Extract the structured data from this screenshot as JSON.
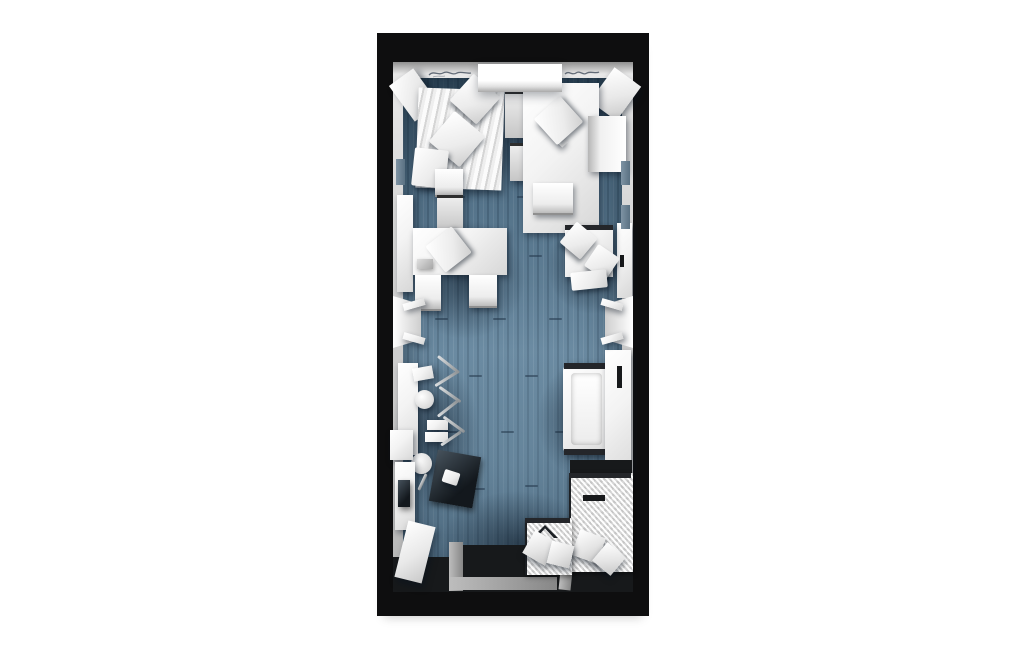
{
  "scene": {
    "description": "3D top-down render of a narrow studio room floor plan on a white background",
    "background": "#ffffff",
    "colors": {
      "outer_wall": "#0e0e0f",
      "wall_lining": "#cfcfcf",
      "floor": "#5f8098",
      "floor_shadow": "#31465a",
      "furniture": "#f3f3f3",
      "entry_floor": "#17191b",
      "ramp": "#9a9a9a",
      "bath_mat": "#ededed"
    },
    "wall_inscriptions": {
      "left": "illegible cursive inscription on top wall (left of beam)",
      "right": "illegible cursive inscription on top wall (right of beam)"
    }
  },
  "plan": {
    "items": [
      {
        "n": "floor-seam",
        "k": "seam",
        "x": 75,
        "y": 163,
        "w": 13,
        "h": 2
      },
      {
        "n": "floor-seam",
        "k": "seam",
        "x": 140,
        "y": 163,
        "w": 13,
        "h": 2
      },
      {
        "n": "floor-seam",
        "k": "seam",
        "x": 196,
        "y": 160,
        "w": 13,
        "h": 2
      },
      {
        "n": "floor-seam",
        "k": "seam",
        "x": 97,
        "y": 222,
        "w": 13,
        "h": 2
      },
      {
        "n": "floor-seam",
        "k": "seam",
        "x": 152,
        "y": 222,
        "w": 13,
        "h": 2
      },
      {
        "n": "floor-seam",
        "k": "seam",
        "x": 58,
        "y": 285,
        "w": 13,
        "h": 2
      },
      {
        "n": "floor-seam",
        "k": "seam",
        "x": 116,
        "y": 285,
        "w": 13,
        "h": 2
      },
      {
        "n": "floor-seam",
        "k": "seam",
        "x": 172,
        "y": 285,
        "w": 13,
        "h": 2
      },
      {
        "n": "floor-seam",
        "k": "seam",
        "x": 92,
        "y": 342,
        "w": 13,
        "h": 2
      },
      {
        "n": "floor-seam",
        "k": "seam",
        "x": 148,
        "y": 342,
        "w": 13,
        "h": 2
      },
      {
        "n": "floor-seam",
        "k": "seam",
        "x": 203,
        "y": 342,
        "w": 13,
        "h": 2
      },
      {
        "n": "floor-seam",
        "k": "seam",
        "x": 68,
        "y": 398,
        "w": 13,
        "h": 2
      },
      {
        "n": "floor-seam",
        "k": "seam",
        "x": 124,
        "y": 398,
        "w": 13,
        "h": 2
      },
      {
        "n": "floor-seam",
        "k": "seam",
        "x": 178,
        "y": 398,
        "w": 13,
        "h": 2
      },
      {
        "n": "floor-seam",
        "k": "seam",
        "x": 95,
        "y": 455,
        "w": 13,
        "h": 2
      },
      {
        "n": "floor-seam",
        "k": "seam",
        "x": 148,
        "y": 452,
        "w": 13,
        "h": 2
      },
      {
        "n": "floor-shadow-top-right",
        "k": "shadow",
        "x": 110,
        "y": 46,
        "w": 118,
        "h": 125
      },
      {
        "n": "floor-shadow-bed-top-left",
        "k": "shadow",
        "x": 32,
        "y": 56,
        "w": 106,
        "h": 115
      },
      {
        "n": "floor-shadow-desk-left",
        "k": "shadow",
        "x": 28,
        "y": 186,
        "w": 120,
        "h": 120
      },
      {
        "n": "floor-shadow-armchair",
        "k": "shadow",
        "x": 170,
        "y": 186,
        "w": 88,
        "h": 95
      },
      {
        "n": "floor-shadow-bed-right",
        "k": "shadow",
        "x": 160,
        "y": 328,
        "w": 98,
        "h": 118
      },
      {
        "n": "floor-shadow-counter",
        "k": "shadow",
        "x": 14,
        "y": 326,
        "w": 88,
        "h": 152
      },
      {
        "n": "floor-shadow-bottom",
        "k": "shadow",
        "x": 64,
        "y": 458,
        "w": 152,
        "h": 104
      },
      {
        "n": "beam-light-glow",
        "k": "glow",
        "x": 94,
        "y": 50,
        "w": 100,
        "h": 60
      },
      {
        "n": "entry-floor",
        "k": "dark",
        "x": 78,
        "y": 512,
        "w": 178,
        "h": 47
      },
      {
        "n": "entry-floor-left",
        "k": "dark",
        "x": 16,
        "y": 524,
        "w": 66,
        "h": 35
      },
      {
        "n": "entry-ramp-side",
        "k": "grayramp",
        "x": 72,
        "y": 509,
        "w": 14,
        "h": 49
      },
      {
        "n": "entry-ramp-bottom",
        "k": "grayramp",
        "x": 72,
        "y": 544,
        "w": 108,
        "h": 13
      },
      {
        "n": "entry-ramp-divider",
        "k": "grayramp",
        "x": 184,
        "y": 509,
        "w": 12,
        "h": 48,
        "r": 6
      },
      {
        "n": "corner-panel-top-left",
        "k": "panel",
        "x": 22,
        "y": 40,
        "w": 30,
        "h": 44,
        "r": -36
      },
      {
        "n": "corner-panel-top-right",
        "k": "panel",
        "x": 222,
        "y": 40,
        "w": 33,
        "h": 42,
        "r": 36
      },
      {
        "n": "bed-duvet",
        "k": "stripe",
        "x": 40,
        "y": 56,
        "w": 86,
        "h": 100,
        "r": 2
      },
      {
        "n": "bed-pillow-1",
        "k": "pillow",
        "x": 80,
        "y": 48,
        "w": 36,
        "h": 36,
        "r": 42
      },
      {
        "n": "bed-pillow-2",
        "k": "pillow",
        "x": 60,
        "y": 86,
        "w": 40,
        "h": 40,
        "r": 40
      },
      {
        "n": "bed-sheet-fold",
        "k": "pillow",
        "x": 36,
        "y": 116,
        "w": 34,
        "h": 38,
        "r": 6
      },
      {
        "n": "nightstand-upper",
        "k": "boxdark",
        "x": 128,
        "y": 58,
        "w": 34,
        "h": 44
      },
      {
        "n": "nightstand-lower",
        "k": "boxdark",
        "x": 133,
        "y": 110,
        "w": 28,
        "h": 35
      },
      {
        "n": "desk-window",
        "k": "white",
        "x": 146,
        "y": 50,
        "w": 76,
        "h": 150
      },
      {
        "n": "desk-chair-back",
        "k": "white",
        "x": 158,
        "y": 94,
        "w": 36,
        "h": 9,
        "r": 46
      },
      {
        "n": "desk-chair-seat",
        "k": "pillow",
        "x": 164,
        "y": 70,
        "w": 35,
        "h": 35,
        "r": -42
      },
      {
        "n": "side-chair-right",
        "k": "chairleft",
        "x": 211,
        "y": 83,
        "w": 38,
        "h": 56
      },
      {
        "n": "desk-stool",
        "k": "chairv",
        "x": 156,
        "y": 150,
        "w": 40,
        "h": 30
      },
      {
        "n": "cabinet-right",
        "k": "white",
        "x": 240,
        "y": 190,
        "w": 15,
        "h": 75
      },
      {
        "n": "cabinet-right-handle",
        "k": "dark",
        "x": 243,
        "y": 222,
        "w": 4,
        "h": 12
      },
      {
        "n": "cabinet-left",
        "k": "white",
        "x": 20,
        "y": 162,
        "w": 16,
        "h": 97
      },
      {
        "n": "chair-desk-north",
        "k": "chairv",
        "x": 58,
        "y": 136,
        "w": 28,
        "h": 26
      },
      {
        "n": "drawer-unit",
        "k": "boxdark",
        "x": 60,
        "y": 162,
        "w": 26,
        "h": 32
      },
      {
        "n": "desk-meeting",
        "k": "white",
        "x": 36,
        "y": 195,
        "w": 94,
        "h": 47
      },
      {
        "n": "desk-tray",
        "k": "gray",
        "x": 40,
        "y": 226,
        "w": 16,
        "h": 10
      },
      {
        "n": "chair-on-desk",
        "k": "pillow",
        "x": 55,
        "y": 200,
        "w": 33,
        "h": 33,
        "r": -38
      },
      {
        "n": "chair-desk-south-1",
        "k": "chairv",
        "x": 38,
        "y": 242,
        "w": 26,
        "h": 34
      },
      {
        "n": "chair-desk-south-2",
        "k": "chairv",
        "x": 92,
        "y": 242,
        "w": 28,
        "h": 31
      },
      {
        "n": "armchair-base",
        "k": "white",
        "x": 188,
        "y": 192,
        "w": 48,
        "h": 52
      },
      {
        "n": "armchair-frame",
        "k": "darkstrip",
        "x": 188,
        "y": 192,
        "w": 48,
        "h": 5
      },
      {
        "n": "armchair-pillow-1",
        "k": "pillow",
        "x": 188,
        "y": 194,
        "w": 27,
        "h": 27,
        "r": 40
      },
      {
        "n": "armchair-pillow-2",
        "k": "pillow",
        "x": 212,
        "y": 216,
        "w": 26,
        "h": 26,
        "r": 34
      },
      {
        "n": "armchair-throw",
        "k": "pillow",
        "x": 194,
        "y": 238,
        "w": 36,
        "h": 18,
        "r": -6
      },
      {
        "n": "counter-left",
        "k": "white",
        "x": 21,
        "y": 330,
        "w": 20,
        "h": 92
      },
      {
        "n": "stool-seat-1",
        "k": "white",
        "x": 36,
        "y": 334,
        "w": 20,
        "h": 13,
        "r": -10
      },
      {
        "n": "stool-leg",
        "k": "metal",
        "x": 58,
        "y": 330,
        "w": 27,
        "h": 3,
        "r": 38
      },
      {
        "n": "stool-leg",
        "k": "metal",
        "x": 56,
        "y": 344,
        "w": 28,
        "h": 3,
        "r": -32
      },
      {
        "n": "stool-seat-2",
        "k": "round",
        "x": 38,
        "y": 357,
        "w": 19,
        "h": 19
      },
      {
        "n": "stool-leg",
        "k": "metal",
        "x": 60,
        "y": 360,
        "w": 26,
        "h": 3,
        "r": 35
      },
      {
        "n": "stool-leg",
        "k": "metal",
        "x": 58,
        "y": 374,
        "w": 26,
        "h": 3,
        "r": -38
      },
      {
        "n": "stool-seat-3",
        "k": "white",
        "x": 50,
        "y": 387,
        "w": 21,
        "h": 10
      },
      {
        "n": "stool-seat-4",
        "k": "white",
        "x": 48,
        "y": 399,
        "w": 23,
        "h": 10
      },
      {
        "n": "stool-leg",
        "k": "metal",
        "x": 64,
        "y": 390,
        "w": 26,
        "h": 3,
        "r": 36
      },
      {
        "n": "stool-leg",
        "k": "metal",
        "x": 62,
        "y": 404,
        "w": 24,
        "h": 3,
        "r": -34
      },
      {
        "n": "desk-dark",
        "k": "glass",
        "x": 56,
        "y": 420,
        "w": 44,
        "h": 52,
        "r": 10
      },
      {
        "n": "desk-dark-paper",
        "k": "pillow",
        "x": 66,
        "y": 438,
        "w": 16,
        "h": 13,
        "r": 18
      },
      {
        "n": "stool-seat-5",
        "k": "round",
        "x": 34,
        "y": 420,
        "w": 21,
        "h": 21
      },
      {
        "n": "stool-leg",
        "k": "metal",
        "x": 44,
        "y": 440,
        "w": 3,
        "h": 18,
        "r": 25
      },
      {
        "n": "daybed-frame",
        "k": "whiteround",
        "x": 186,
        "y": 330,
        "w": 47,
        "h": 92
      },
      {
        "n": "daybed-trim-top",
        "k": "darkstrip",
        "x": 187,
        "y": 330,
        "w": 45,
        "h": 6
      },
      {
        "n": "daybed-trim-bottom",
        "k": "darkstrip",
        "x": 187,
        "y": 416,
        "w": 45,
        "h": 6
      },
      {
        "n": "daybed-mattress",
        "k": "mattress",
        "x": 194,
        "y": 340,
        "w": 31,
        "h": 72
      },
      {
        "n": "wardrobe-right",
        "k": "white",
        "x": 228,
        "y": 317,
        "w": 26,
        "h": 135
      },
      {
        "n": "wardrobe-handle",
        "k": "dark",
        "x": 240,
        "y": 333,
        "w": 5,
        "h": 22
      },
      {
        "n": "bath-dark-recess",
        "k": "dark",
        "x": 193,
        "y": 427,
        "w": 62,
        "h": 14
      },
      {
        "n": "bath-mat-right",
        "k": "mat",
        "x": 192,
        "y": 440,
        "w": 62,
        "h": 99
      },
      {
        "n": "bath-mat-right-trim",
        "k": "darkstrip",
        "x": 192,
        "y": 440,
        "w": 62,
        "h": 5
      },
      {
        "n": "bath-slot",
        "k": "dark",
        "x": 206,
        "y": 462,
        "w": 22,
        "h": 6
      },
      {
        "n": "bath-cube-1",
        "k": "cube",
        "x": 198,
        "y": 500,
        "w": 27,
        "h": 27,
        "r": 20
      },
      {
        "n": "bath-cube-2",
        "k": "cube",
        "x": 220,
        "y": 514,
        "w": 24,
        "h": 24,
        "r": 40
      },
      {
        "n": "bath-mat-left",
        "k": "mat",
        "x": 148,
        "y": 485,
        "w": 45,
        "h": 57
      },
      {
        "n": "bath-mat-left-trim",
        "k": "darkstrip",
        "x": 148,
        "y": 485,
        "w": 45,
        "h": 5
      },
      {
        "n": "bath-chevron",
        "k": "chevron",
        "x": 155,
        "y": 492,
        "w": 26,
        "h": 13
      },
      {
        "n": "bath-cube-3",
        "k": "cube",
        "x": 150,
        "y": 502,
        "w": 26,
        "h": 26,
        "r": 30
      },
      {
        "n": "bath-cube-4",
        "k": "cube",
        "x": 172,
        "y": 510,
        "w": 23,
        "h": 23,
        "r": 14
      },
      {
        "n": "vanity-top",
        "k": "white",
        "x": 13,
        "y": 397,
        "w": 23,
        "h": 30
      },
      {
        "n": "vanity-unit",
        "k": "white",
        "x": 18,
        "y": 429,
        "w": 20,
        "h": 68
      },
      {
        "n": "vanity-slot",
        "k": "glass",
        "x": 21,
        "y": 447,
        "w": 12,
        "h": 27
      },
      {
        "n": "door-panel",
        "k": "panel",
        "x": 24,
        "y": 490,
        "w": 28,
        "h": 58,
        "r": 14
      },
      {
        "n": "wall-vent-left",
        "k": "walltab",
        "x": 19,
        "y": 126,
        "w": 9,
        "h": 26
      },
      {
        "n": "wall-vent-right-1",
        "k": "walltab",
        "x": 244,
        "y": 128,
        "w": 9,
        "h": 24
      },
      {
        "n": "wall-vent-right-2",
        "k": "walltab",
        "x": 244,
        "y": 172,
        "w": 9,
        "h": 24
      },
      {
        "n": "door-gap-left",
        "k": "gap",
        "x": 6,
        "y": 266,
        "w": 20,
        "h": 46
      },
      {
        "n": "door-reveal-left",
        "k": "reveall",
        "x": 16,
        "y": 263,
        "w": 28,
        "h": 52
      },
      {
        "n": "door-jamb-left-top",
        "k": "white",
        "x": 26,
        "y": 268,
        "w": 22,
        "h": 7,
        "r": -16
      },
      {
        "n": "door-jamb-left-bottom",
        "k": "white",
        "x": 26,
        "y": 302,
        "w": 22,
        "h": 7,
        "r": 16
      },
      {
        "n": "door-gap-right",
        "k": "gap",
        "x": 246,
        "y": 266,
        "w": 20,
        "h": 46
      },
      {
        "n": "door-reveal-right",
        "k": "revealr",
        "x": 228,
        "y": 263,
        "w": 28,
        "h": 52
      },
      {
        "n": "door-jamb-right-top",
        "k": "white",
        "x": 224,
        "y": 268,
        "w": 22,
        "h": 7,
        "r": 16
      },
      {
        "n": "door-jamb-right-bottom",
        "k": "white",
        "x": 224,
        "y": 302,
        "w": 22,
        "h": 7,
        "r": -16
      },
      {
        "n": "ceiling-beam",
        "k": "beam",
        "x": 101,
        "y": 31,
        "w": 84,
        "h": 28
      }
    ]
  }
}
